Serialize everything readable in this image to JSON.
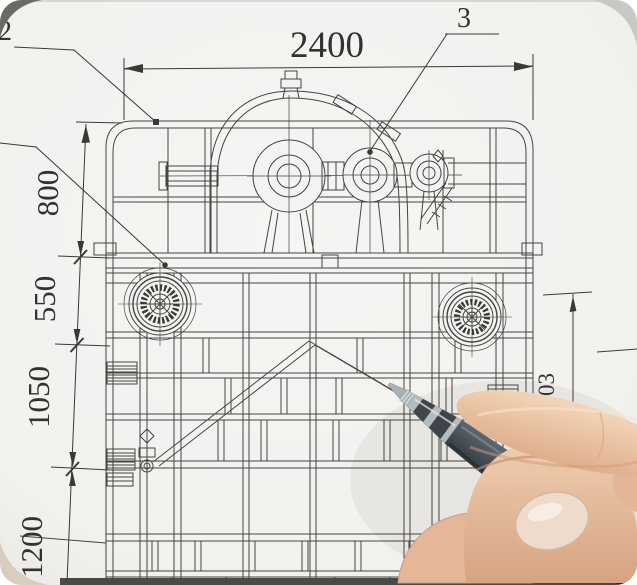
{
  "dimensions": {
    "top_width": "2400",
    "left_chain": [
      "800",
      "550",
      "1050",
      "1200"
    ],
    "right_height": "1403"
  },
  "callouts": {
    "part_2": "2",
    "part_3": "3"
  },
  "colors": {
    "paper": "#f4f3f1",
    "drawing_line": "#45443f",
    "pen_barrel": "#3f474f",
    "skin": "#e9c3a2"
  }
}
